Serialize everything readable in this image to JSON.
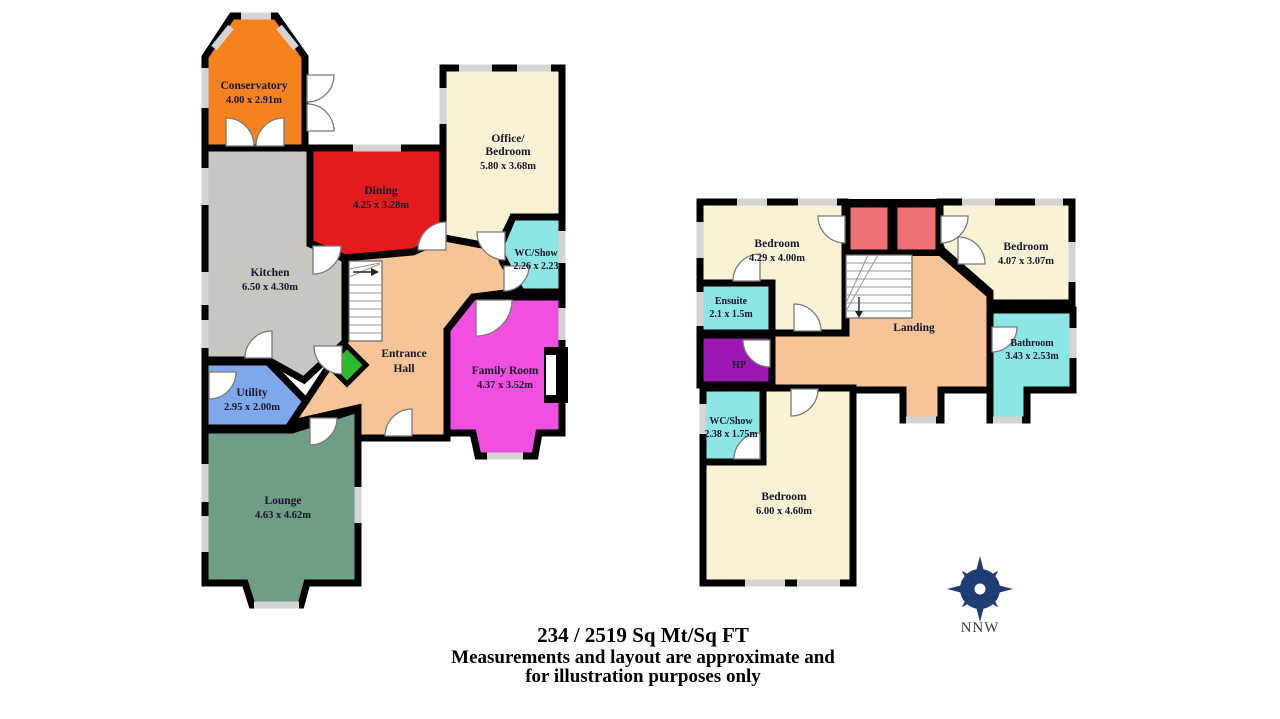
{
  "rooms": {
    "conservatory": {
      "name": "Conservatory",
      "dims": "4.00 x 2.91m"
    },
    "kitchen": {
      "name": "Kitchen",
      "dims": "6.50 x 4.30m"
    },
    "dining": {
      "name": "Dining",
      "dims": "4.25 x 3.28m"
    },
    "office_bedroom": {
      "name_line1": "Office/",
      "name_line2": "Bedroom",
      "dims": "5.80 x 3.68m"
    },
    "wc_show_ground": {
      "name": "WC/Show",
      "dims": "2.26 x 2.23"
    },
    "entrance_hall": {
      "name_line1": "Entrance",
      "name_line2": "Hall"
    },
    "family_room": {
      "name": "Family Room",
      "dims": "4.37 x 3.52m"
    },
    "utility": {
      "name": "Utility",
      "dims": "2.95 x 2.00m"
    },
    "lounge": {
      "name": "Lounge",
      "dims": "4.63 x 4.62m"
    },
    "bedroom_front": {
      "name": "Bedroom",
      "dims": "4.29 x 4.00m"
    },
    "bedroom_right": {
      "name": "Bedroom",
      "dims": "4.07 x 3.07m"
    },
    "ensuite": {
      "name": "Ensuite",
      "dims": "2.1 x 1.5m"
    },
    "hp": {
      "name": "HP"
    },
    "landing": {
      "name": "Landing"
    },
    "bathroom": {
      "name": "Bathroom",
      "dims": "3.43 x 2.53m"
    },
    "wc_show_first": {
      "name": "WC/Show",
      "dims": "2.38 x 1.75m"
    },
    "bedroom_rear": {
      "name": "Bedroom",
      "dims": "6.00 x 4.60m"
    }
  },
  "footer": {
    "area_line": "234 / 2519 Sq Mt/Sq FT",
    "disclaimer_line1": "Measurements and layout are approximate and",
    "disclaimer_line2": "for illustration purposes only"
  },
  "compass": {
    "direction_label": "NNW"
  },
  "colors": {
    "conservatory": "#F5821E",
    "dining": "#E41B1C",
    "kitchen": "#C9C5C1",
    "office": "#FAF2D5",
    "wc": "#8BE6E4",
    "hall": "#F6C497",
    "family": "#F04FE0",
    "utility": "#7FA7EB",
    "lounge": "#6F9D86",
    "cupboard_green": "#2CBB2C",
    "bedroom_cream": "#FAF2D5",
    "landing": "#F6C497",
    "wardrobe_red": "#ED7174",
    "hp_purple": "#9C17B4",
    "compass_navy": "#1F3D73"
  }
}
